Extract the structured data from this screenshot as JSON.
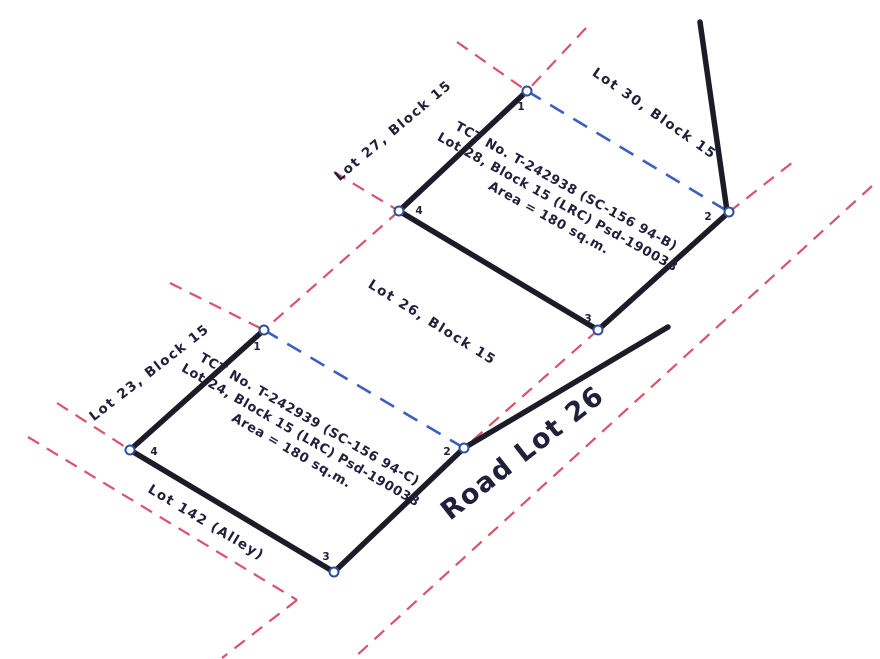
{
  "drawing": {
    "type": "subdivision-survey-sketch",
    "background": "#ffffff"
  },
  "colors": {
    "parcel_line": "#1c1c28",
    "tie_line": "#3c5fc0",
    "adjacent_boundary": "#d9536b",
    "marker_stroke": "#2d4fa0",
    "marker_fill": "#ffffff",
    "text": "#20203a"
  },
  "labels": {
    "lot27": "Lot 27, Block 15",
    "lot30": "Lot 30, Block 15",
    "lot26": "Lot 26, Block 15",
    "lot23": "Lot 23, Block 15",
    "alley": "Lot 142 (Alley)",
    "road": "Road Lot 26"
  },
  "parcels": [
    {
      "name": "upper-parcel",
      "tct_lines": [
        "TCT No. T-242938 (SC-156 94-B)",
        "Lot 28, Block 15 (LRC) Psd-190038",
        "Area = 180 sq.m."
      ],
      "vertices": [
        "1",
        "2",
        "3",
        "4"
      ]
    },
    {
      "name": "lower-parcel",
      "tct_lines": [
        "TCT No. T-242939 (SC-156 94-C)",
        "Lot 24, Block 15 (LRC) Psd-190038",
        "Area = 180 sq.m."
      ],
      "vertices": [
        "1",
        "2",
        "3",
        "4"
      ]
    }
  ]
}
